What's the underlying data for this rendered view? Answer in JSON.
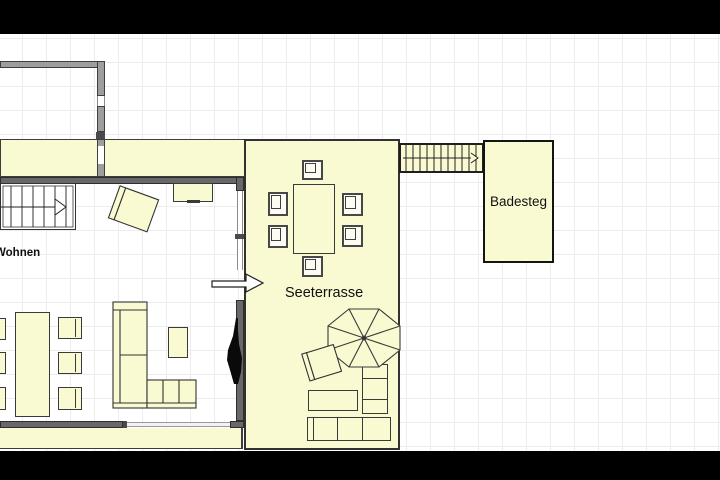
{
  "image": {
    "type": "architectural floor plan frame with letterbox bars"
  },
  "labels": {
    "living_room": "Wohnen",
    "lake_terrace": "Seeterrasse",
    "bathing_jetty": "Badesteg"
  },
  "colors": {
    "room_fill": "#FAFAD2",
    "chair_fill": "#FCFCF2",
    "wall_fill": "#9E9E9E",
    "wall_dark_fill": "#686868",
    "outline": "#3A3A3A",
    "grid_line": "#ECECEC",
    "canvas_background": "#FFFFFF",
    "label_text": "#101010",
    "letterbox": "#000000"
  }
}
